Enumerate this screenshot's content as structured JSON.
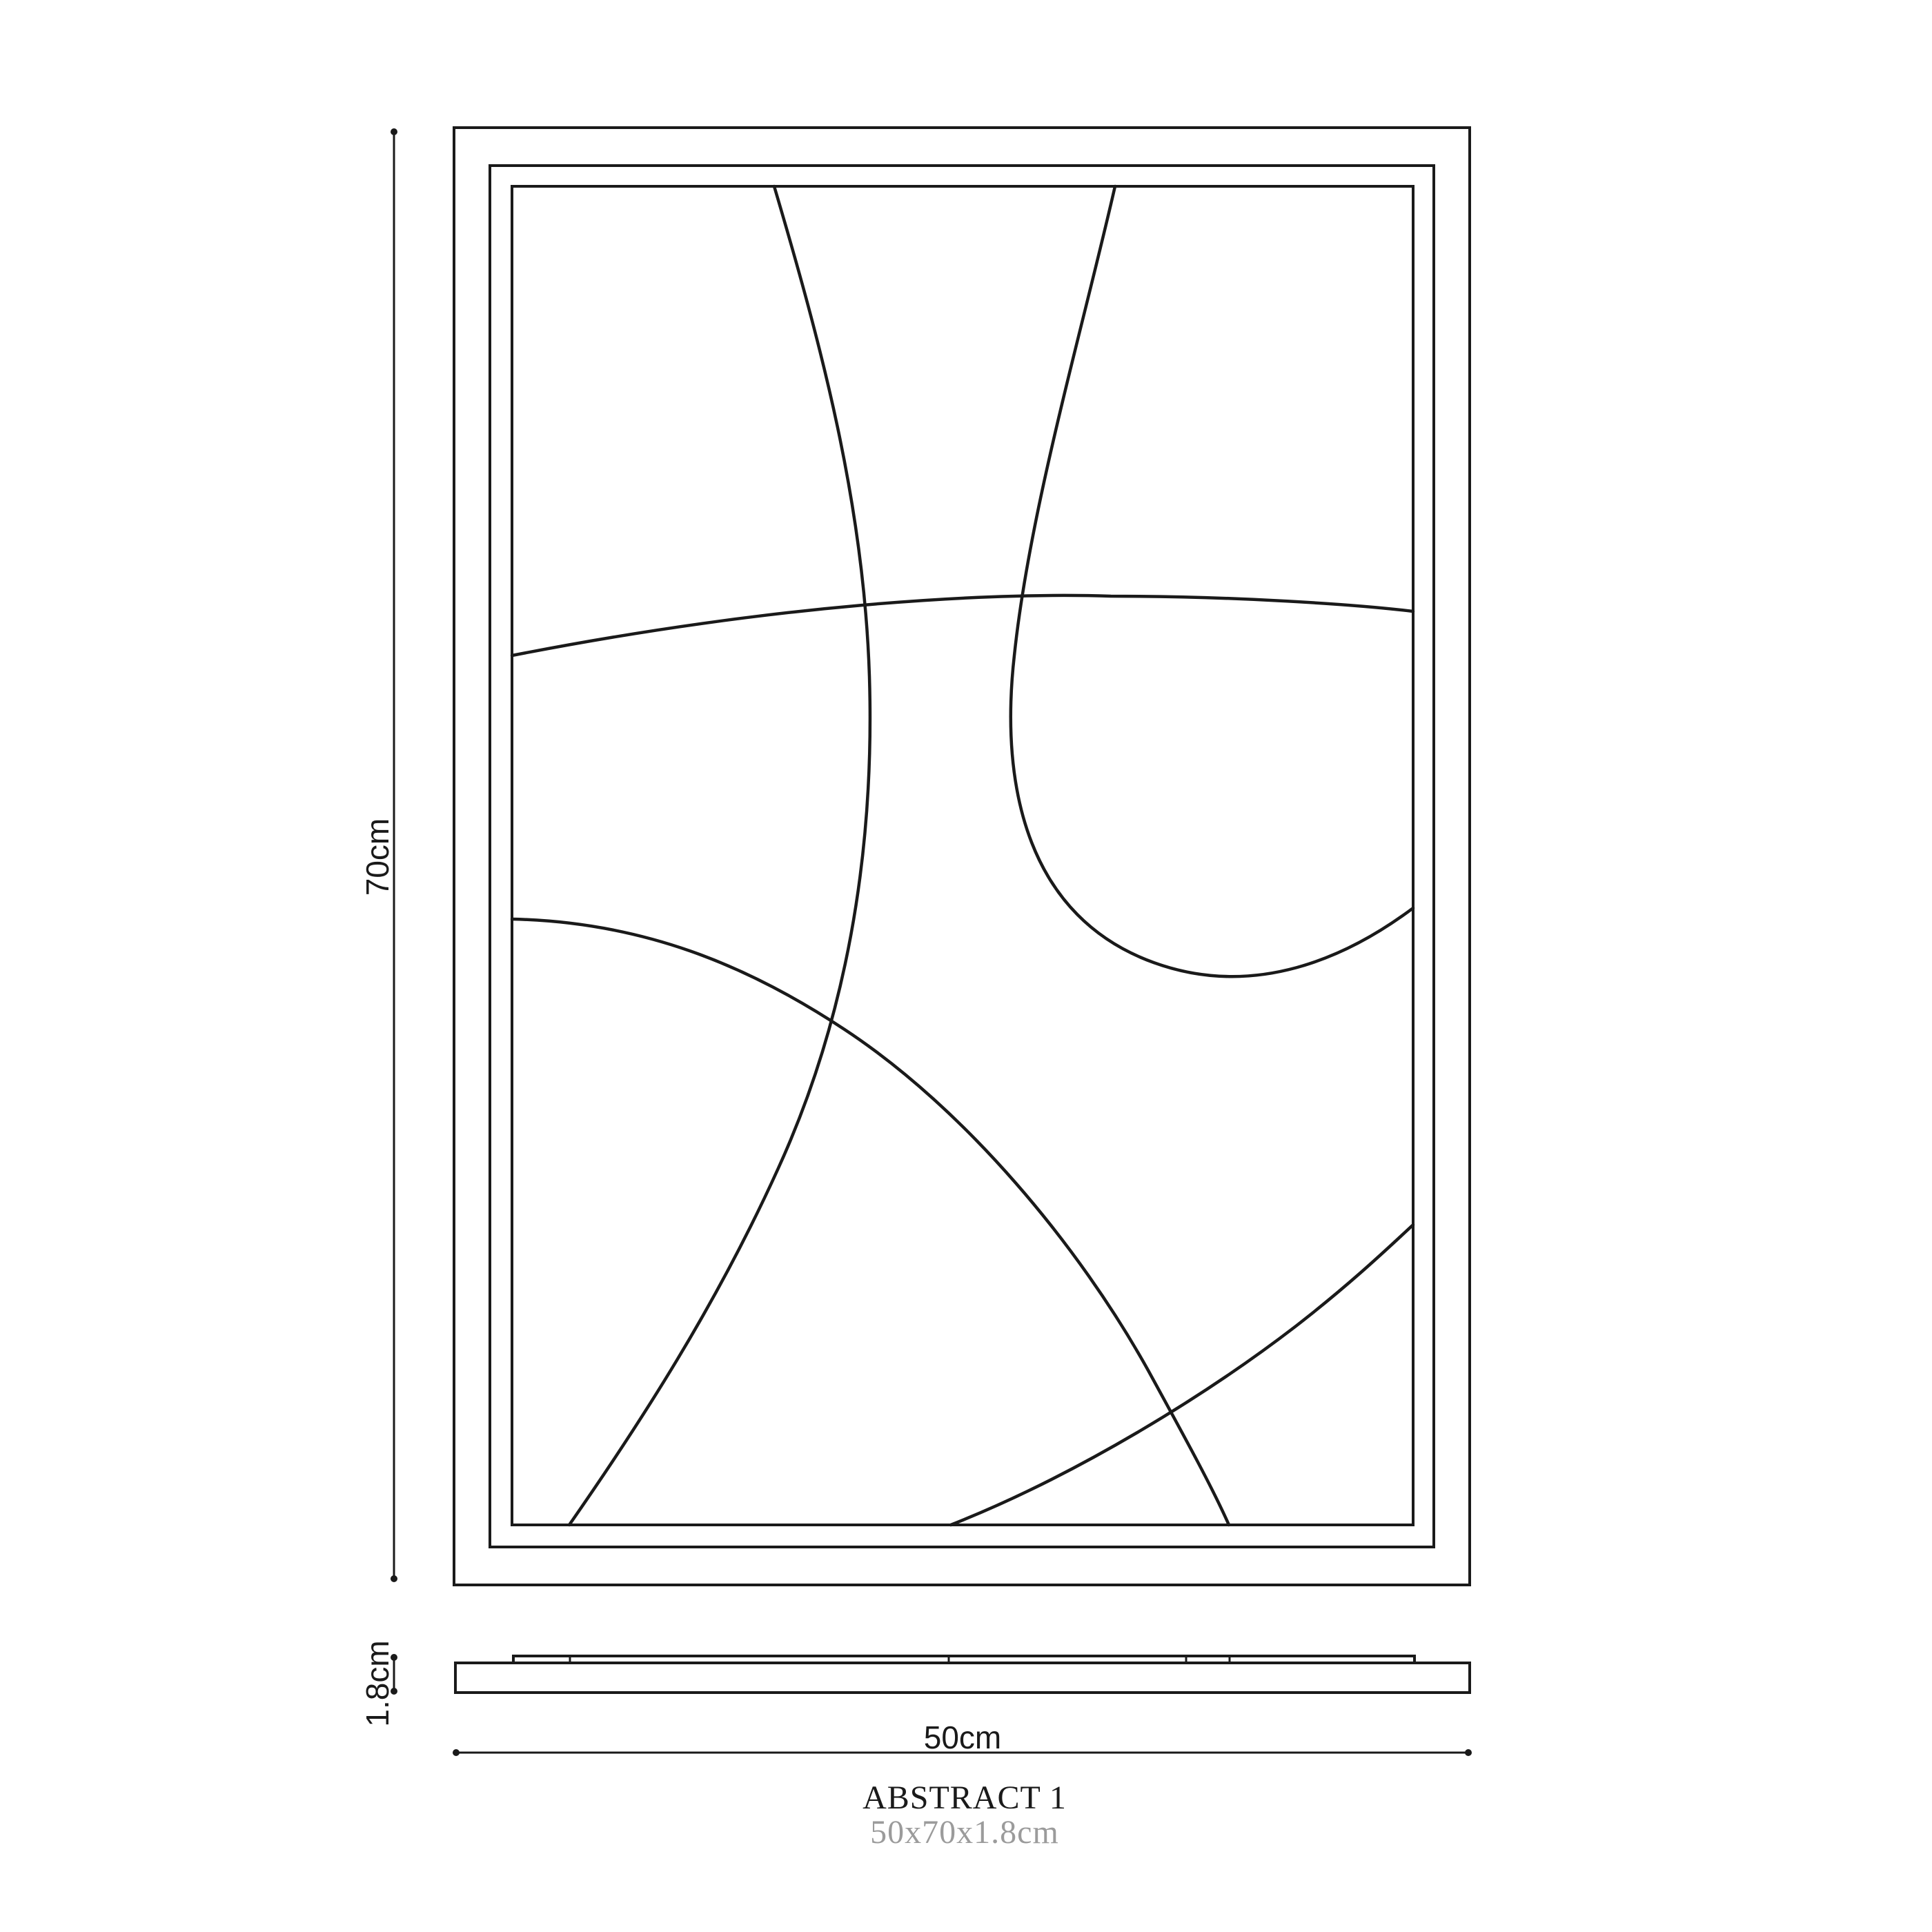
{
  "colors": {
    "ink": "#1a1a1a",
    "muted": "#9b9b9b",
    "background": "#ffffff"
  },
  "dimensions": {
    "height": {
      "label": "70cm",
      "value_cm": 70
    },
    "width": {
      "label": "50cm",
      "value_cm": 50
    },
    "thickness": {
      "label": "1.8cm",
      "value_cm": 1.8
    }
  },
  "caption": {
    "title": "ABSTRACT 1",
    "size": "50x70x1.8cm"
  }
}
